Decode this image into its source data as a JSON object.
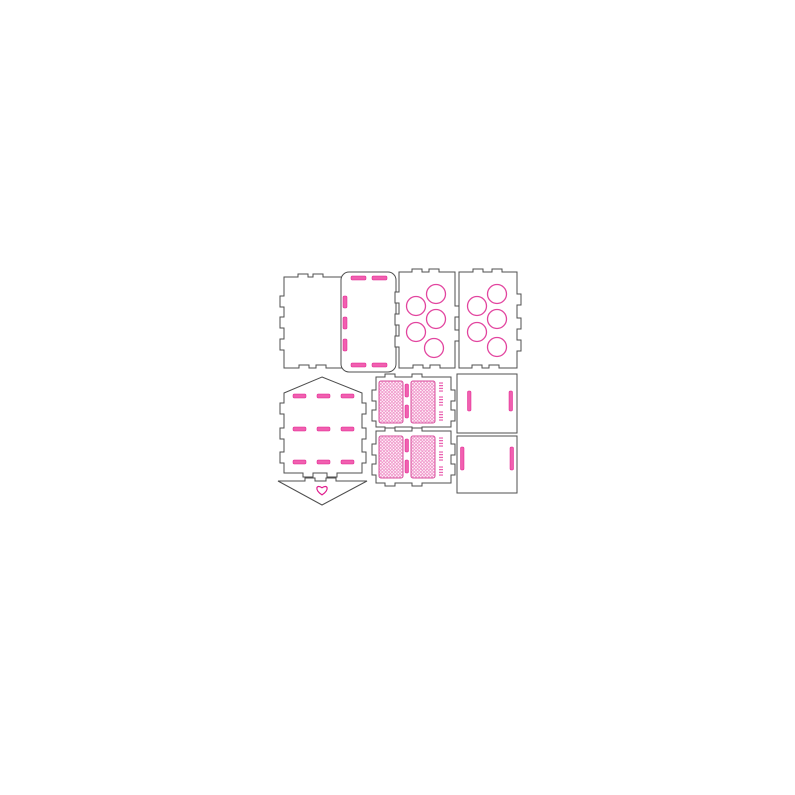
{
  "canvas": {
    "width": 795,
    "height": 795,
    "background": "#ffffff"
  },
  "drawing": {
    "description": "laser-cut heart envelope gift box template with circle trays, lattice panels and score slots",
    "colors": {
      "cut": "#4f4f4f",
      "score": "#e01a8c",
      "score_fill": "#f160b0",
      "circle": "#e2459f",
      "lattice_line": "#ef8ec6",
      "lattice_border": "#d8509e",
      "background": "#ffffff"
    },
    "panels": [
      {
        "name": "side-panel-left",
        "path": "M284,277 H298 V274 H308 V277 H313 V274 H323 V277 H344 V296 H348 V307 H344 V317 H348 V328 H344 V339 H348 V350 H344 V368 H326 V365 H316 V368 H309 V365 H299 V368 H284 V350 H280 V339 H284 V328 H280 V317 H284 V307 H280 V296 H284 Z"
      },
      {
        "name": "lid-panel-rounded",
        "rect": [
          341,
          272,
          55,
          100,
          8
        ],
        "slots": [
          [
            351,
            276,
            15,
            4
          ],
          [
            372,
            276,
            15,
            4
          ],
          [
            351,
            363,
            15,
            4
          ],
          [
            372,
            363,
            15,
            4
          ],
          [
            343,
            296,
            4,
            12
          ],
          [
            343,
            317,
            4,
            12
          ],
          [
            343,
            339,
            4,
            12
          ]
        ]
      },
      {
        "name": "circle-tray-left",
        "path": "M399,272 H412 V269 H422 V272 H429 V269 H439 V272 H455 V306 H459 V317 H455 V330 H459 V341 H455 V368 H440 V365 H430 V368 H423 V365 H413 V368 H399 V347 H395 V336 H399 V325 H395 V314 H399 V303 H395 V292 H399 Z",
        "circles": [
          [
            416,
            306,
            9.5
          ],
          [
            416,
            332,
            9.5
          ],
          [
            436,
            294,
            9.5
          ],
          [
            436,
            319,
            9.5
          ],
          [
            434,
            348,
            9.5
          ]
        ]
      },
      {
        "name": "circle-tray-right",
        "path": "M459,272 H473 V269 H483 V272 H492 V269 H502 V272 H517 V294 H521 V305 H517 V318 H521 V329 H517 V340 H521 V351 H517 V368 H499 V365 H489 V368 H482 V365 H472 V368 H459 Z",
        "circles": [
          [
            477,
            306,
            9.5
          ],
          [
            477,
            332,
            9.5
          ],
          [
            497,
            294,
            9.5
          ],
          [
            497,
            319,
            9.5
          ],
          [
            497,
            347,
            9.5
          ]
        ]
      },
      {
        "name": "envelope-body",
        "path": "M322,377 L362,393 V403 H366 V414 H362 V428 H366 V439 H362 V452 H366 V463 H362 V473 H337 V477 H327 V473 H313 V477 H303 V473 H284 V463 H280 V452 H284 V439 H280 V428 H284 V414 H280 V403 H284 V393 Z",
        "slots": [
          [
            293,
            394,
            13,
            4
          ],
          [
            317,
            394,
            13,
            4
          ],
          [
            341,
            394,
            13,
            4
          ],
          [
            293,
            427,
            13,
            4
          ],
          [
            317,
            427,
            13,
            4
          ],
          [
            341,
            427,
            13,
            4
          ],
          [
            293,
            460,
            13,
            4
          ],
          [
            317,
            460,
            13,
            4
          ],
          [
            341,
            460,
            13,
            4
          ]
        ]
      },
      {
        "name": "envelope-flap",
        "path": "M278,481 H305 V478 H315 V481 H326 V478 H336 V481 H367 L322,505 Z",
        "heart": [
          322,
          490,
          6.5
        ]
      },
      {
        "name": "lattice-panel-top",
        "path": "M376,377 H385 V374 H395 V377 H412 V374 H422 V377 H451 V390 H455 V401 H451 V410 H455 V421 H451 V427 H422 V430 H412 V427 H395 V430 H385 V427 H376 V421 H372 V410 H376 V401 H372 V390 H376 Z",
        "lattice": [
          [
            379,
            381,
            24,
            42
          ],
          [
            411,
            381,
            24,
            42
          ]
        ],
        "slots": [
          [
            405,
            384,
            3.5,
            13
          ],
          [
            405,
            405,
            3.5,
            13
          ]
        ],
        "dot_strips": [
          [
            439,
            382,
            4,
            10
          ],
          [
            439,
            396,
            4,
            10
          ],
          [
            439,
            411,
            4,
            10
          ]
        ]
      },
      {
        "name": "lattice-panel-bottom",
        "path": "M376,431 H385 V428 H395 V431 H412 V428 H422 V431 H451 V444 H455 V455 H451 V464 H455 V475 H451 V483 H422 V486 H412 V483 H395 V486 H385 V483 H376 V475 H372 V464 H376 V455 H372 V444 H376 Z",
        "lattice": [
          [
            379,
            436,
            24,
            42
          ],
          [
            411,
            436,
            24,
            42
          ]
        ],
        "slots": [
          [
            405,
            439,
            3.5,
            13
          ],
          [
            405,
            460,
            3.5,
            13
          ]
        ],
        "dot_strips": [
          [
            439,
            437,
            4,
            10
          ],
          [
            439,
            451,
            4,
            10
          ],
          [
            439,
            466,
            4,
            10
          ]
        ]
      },
      {
        "name": "square-panel-top",
        "rect": [
          457,
          374,
          60,
          59,
          0
        ],
        "slots": [
          [
            467.5,
            391,
            3.5,
            20
          ],
          [
            509,
            391,
            3.5,
            20
          ]
        ]
      },
      {
        "name": "square-panel-bottom",
        "rect": [
          457,
          436,
          60,
          57,
          0
        ],
        "slots": [
          [
            460.5,
            447,
            3.5,
            23
          ],
          [
            510,
            447,
            3.5,
            23
          ]
        ]
      }
    ]
  }
}
